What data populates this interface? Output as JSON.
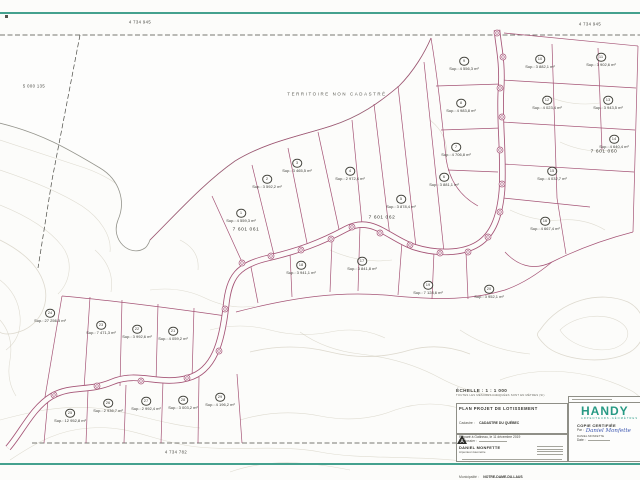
{
  "map": {
    "water_label": "TERRITOIRE NON CADASTRÉ",
    "adjacent_lots": [
      {
        "text": "4 734 945",
        "x": 140,
        "y": 23
      },
      {
        "text": "4 734 945",
        "x": 590,
        "y": 25
      },
      {
        "text": "5 000 135",
        "x": 34,
        "y": 87
      },
      {
        "text": "4 734 782",
        "x": 176,
        "y": 453
      }
    ],
    "block_lots": [
      {
        "text": "7 601 060",
        "x": 604,
        "y": 152
      },
      {
        "text": "7 601 061",
        "x": 246,
        "y": 230
      },
      {
        "text": "7 601 062",
        "x": 382,
        "y": 218
      }
    ],
    "lots": [
      {
        "num": "1",
        "area": "Sup.: 4 559,3 m²",
        "x": 241,
        "y": 212
      },
      {
        "num": "2",
        "area": "Sup.: 3 592,2 m²",
        "x": 267,
        "y": 178
      },
      {
        "num": "3",
        "area": "Sup.: 3 465,5 m²",
        "x": 297,
        "y": 162
      },
      {
        "num": "4",
        "area": "Sup.: 2 972,4 m²",
        "x": 350,
        "y": 170
      },
      {
        "num": "5",
        "area": "Sup.: 3 878,4 m²",
        "x": 401,
        "y": 198
      },
      {
        "num": "6",
        "area": "Sup.: 3 881,1 m²",
        "x": 444,
        "y": 176
      },
      {
        "num": "7",
        "area": "Sup.: 4 706,8 m²",
        "x": 456,
        "y": 146
      },
      {
        "num": "8",
        "area": "Sup.: 4 983,8 m²",
        "x": 461,
        "y": 102
      },
      {
        "num": "9",
        "area": "Sup.: 4 556,3 m²",
        "x": 464,
        "y": 60
      },
      {
        "num": "10",
        "area": "Sup.: 3 882,1 m²",
        "x": 540,
        "y": 58
      },
      {
        "num": "11",
        "area": "Sup.: 3 902,6 m²",
        "x": 601,
        "y": 56
      },
      {
        "num": "12",
        "area": "Sup.: 4 023,4 m²",
        "x": 547,
        "y": 99
      },
      {
        "num": "13",
        "area": "Sup.: 3 943,5 m²",
        "x": 608,
        "y": 99
      },
      {
        "num": "14",
        "area": "Sup.: 4 640,4 m²",
        "x": 614,
        "y": 138
      },
      {
        "num": "15",
        "area": "Sup.: 4 032,7 m²",
        "x": 552,
        "y": 170
      },
      {
        "num": "16",
        "area": "Sup.: 4 667,4 m²",
        "x": 545,
        "y": 220
      },
      {
        "num": "17",
        "area": "Sup.: 3 841,8 m²",
        "x": 362,
        "y": 260
      },
      {
        "num": "18",
        "area": "Sup.: 3 941,1 m²",
        "x": 301,
        "y": 264
      },
      {
        "num": "19",
        "area": "Sup.: 7 128,6 m²",
        "x": 428,
        "y": 284
      },
      {
        "num": "20",
        "area": "Sup.: 3 952,1 m²",
        "x": 489,
        "y": 288
      },
      {
        "num": "21",
        "area": "Sup.: 4 059,2 m²",
        "x": 173,
        "y": 330
      },
      {
        "num": "22",
        "area": "Sup.: 3 992,6 m²",
        "x": 137,
        "y": 328
      },
      {
        "num": "23",
        "area": "Sup.: 7 471,3 m²",
        "x": 101,
        "y": 324
      },
      {
        "num": "24",
        "area": "Sup.: 27 256,5 m²",
        "x": 50,
        "y": 312
      },
      {
        "num": "25",
        "area": "Sup.: 12 952,8 m²",
        "x": 70,
        "y": 412
      },
      {
        "num": "26",
        "area": "Sup.: 2 936,7 m²",
        "x": 108,
        "y": 402
      },
      {
        "num": "27",
        "area": "Sup.: 2 992,4 m²",
        "x": 146,
        "y": 400
      },
      {
        "num": "28",
        "area": "Sup.: 3 003,2 m²",
        "x": 183,
        "y": 399
      },
      {
        "num": "29",
        "area": "Sup.: 4 196,2 m²",
        "x": 220,
        "y": 396
      }
    ]
  },
  "title_block": {
    "scale_label": "ÉCHELLE : 1 : 1 000",
    "scale_note": "TOUTES LES MESURES INDIQUÉES SONT EN MÈTRES (SI)",
    "plan_type": "PLAN PROJET DE LOTISSEMENT",
    "cadastre_label": "Cadastre :",
    "cadastre": "CADASTRE DU QUÉBEC",
    "circonscription_label": "Circonscription foncière :",
    "circonscription": "LABELLE",
    "lots_label": "Lot(s) :",
    "lots": "7 601 060, 7 601 061 ET 7 601 062",
    "municipality_label": "Municipalité :",
    "municipality": "NOTRE-DAME-DU-LAUS",
    "prepared": "Préparé à Gatineau, le 11 décembre 2019",
    "dossier_label": "No dossier :",
    "surveyor": "DANIEL MONFETTE",
    "surveyor_title": "Arpenteur-Géomètre",
    "firm": "HANDY",
    "firm_sub": "ARPENTEURS-GÉOMÈTRES",
    "certified_label": "COPIE CERTIFIÉE",
    "par_label": "Par :",
    "signature": "Daniel Monfette",
    "signer": "DANIEL MONFETTE",
    "date_label": "Date :"
  },
  "colors": {
    "lot_line": "#a55476",
    "teal_border": "#44a18e",
    "firm_green": "#279a84"
  }
}
